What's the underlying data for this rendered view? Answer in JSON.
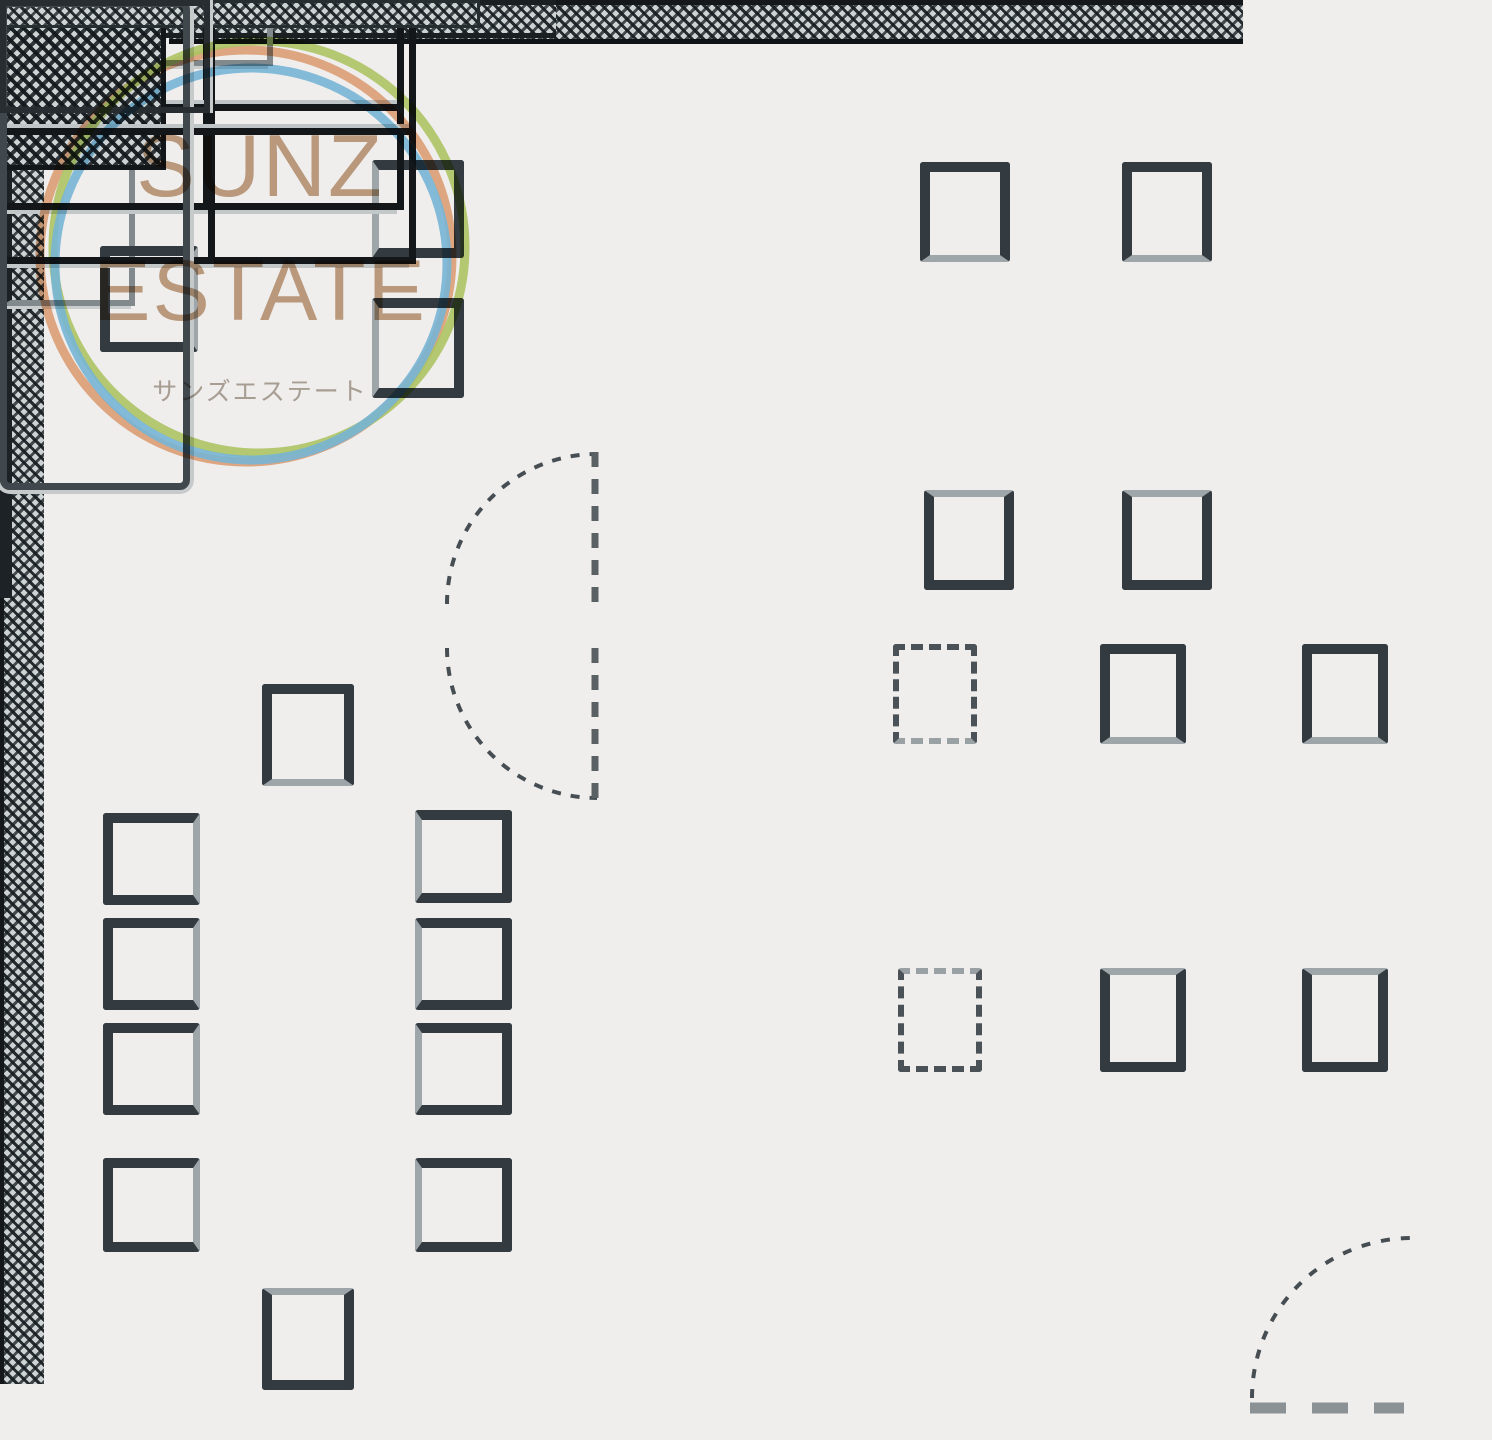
{
  "watermark": {
    "title_line1": "SUNZ",
    "title_line2": "ESTATE",
    "subtitle": "サンズエステート",
    "title_color": "#c6a385",
    "subtitle_color": "#b2a89d",
    "ring_colors": {
      "orange": "#eaa87d",
      "green": "#b9d16c",
      "blue": "#7fc2e5"
    }
  },
  "plan": {
    "background_color": "#efeeed",
    "wall_color": "#14171a",
    "accent_gray": "#9fa6a9",
    "rooms": [
      {
        "name": "executive-room",
        "furniture": "credenza, desk, 3 chairs"
      },
      {
        "name": "meeting-room",
        "furniture": "long table, 10 chairs"
      },
      {
        "name": "open-office",
        "furniture": "2x2 desk cluster with 4 chairs, 3x2 desk cluster (one dashed/planned column) with 6 chairs, hatched storage cabinet, low cabinet strip, base cabinet"
      }
    ],
    "doors": [
      {
        "name": "interior-double-swing-doors",
        "count": 2
      },
      {
        "name": "entrance-door-bottom-right",
        "count": 1
      }
    ]
  }
}
